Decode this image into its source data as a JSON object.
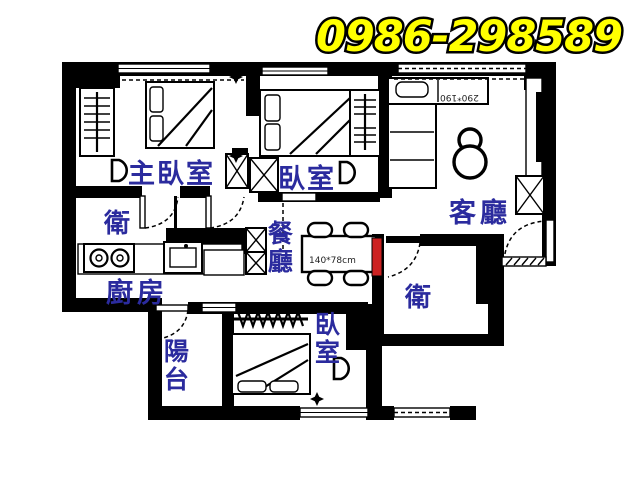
{
  "phone": {
    "number": "0986-298589"
  },
  "rooms": {
    "master_bedroom": {
      "label": "主臥室"
    },
    "bedroom2": {
      "label": "臥室"
    },
    "living_room": {
      "label": "客廳"
    },
    "bath_top": {
      "label": "衛"
    },
    "dining": {
      "label": "餐廳"
    },
    "kitchen": {
      "label": "廚房"
    },
    "bath_right": {
      "label": "衛"
    },
    "balcony": {
      "label": "陽台"
    },
    "bedroom3": {
      "label": "臥室"
    }
  },
  "annotations": {
    "living_dimension": "290*190",
    "dining_table_dimension": "140*78cm"
  },
  "colors": {
    "wall": "#000000",
    "label": "#2b2b9e",
    "phone_fill": "#ffff00",
    "phone_outline": "#000000",
    "accent_door": "#cc2222",
    "background": "#ffffff",
    "dimension_text": "#222222"
  }
}
